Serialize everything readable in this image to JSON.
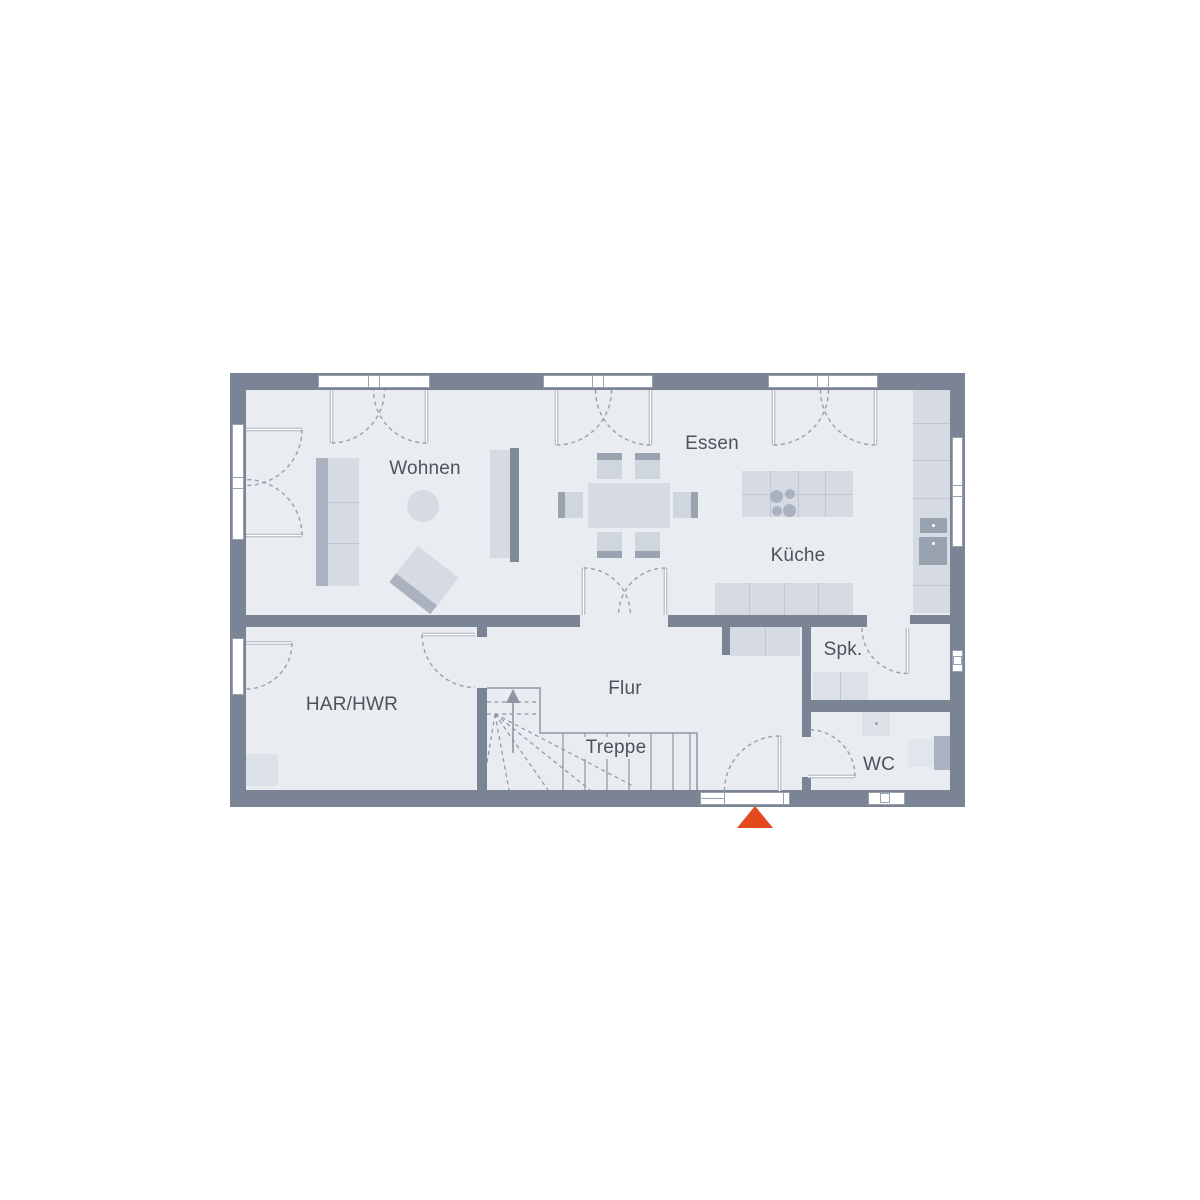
{
  "plan": {
    "type": "floor-plan",
    "rooms": {
      "wohnen": {
        "label": "Wohnen"
      },
      "essen": {
        "label": "Essen"
      },
      "kueche": {
        "label": "Küche"
      },
      "spk": {
        "label": "Spk."
      },
      "flur": {
        "label": "Flur"
      },
      "treppe": {
        "label": "Treppe"
      },
      "har_hwr": {
        "label": "HAR/HWR"
      },
      "wc": {
        "label": "WC"
      }
    },
    "colors": {
      "wall": "#7b8494",
      "floor": "#e9ecf1",
      "furniture": "#d6dbe3",
      "furniture_dark": "#a9b2be",
      "line": "#97a0ad",
      "text": "#4d525b",
      "entrance_marker": "#e2491c"
    },
    "entrance_marker": {
      "icon": "triangle-up",
      "meaning": "main-entrance"
    }
  }
}
